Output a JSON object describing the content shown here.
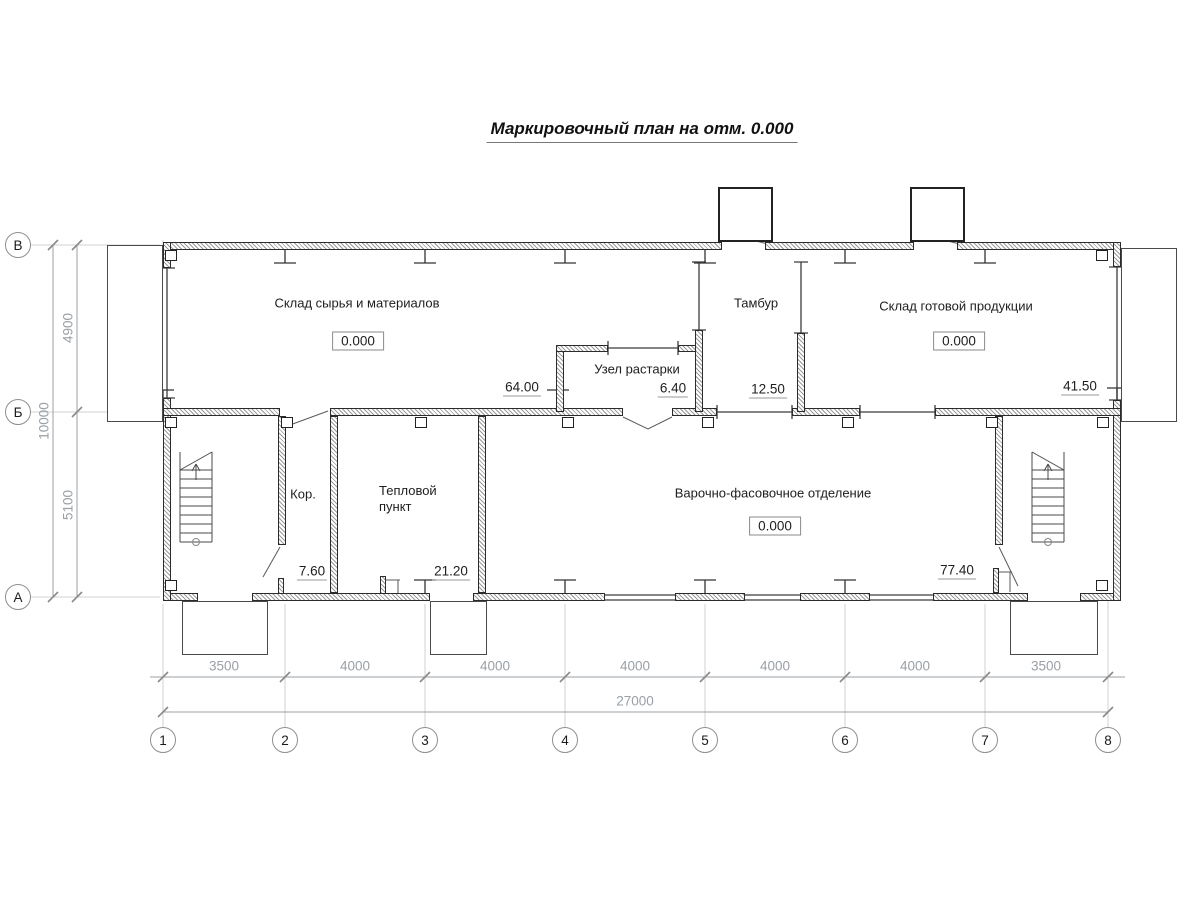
{
  "title": "Маркировочный план на отм. 0.000",
  "rooms": {
    "raw_storage": {
      "label": "Склад сырья и материалов",
      "elevation": "0.000",
      "area": "64.00"
    },
    "unpacking": {
      "label": "Узел растарки",
      "area": "6.40"
    },
    "vestibule": {
      "label": "Тамбур",
      "area": "12.50"
    },
    "finished_storage": {
      "label": "Склад готовой продукции",
      "elevation": "0.000",
      "area": "41.50"
    },
    "corridor": {
      "label": "Кор.",
      "area": "7.60"
    },
    "heat_point": {
      "label": "Тепловой пункт",
      "area": "21.20"
    },
    "cooking": {
      "label": "Варочно-фасовочное отделение",
      "elevation": "0.000",
      "area": "77.40"
    }
  },
  "grid": {
    "columns": [
      "1",
      "2",
      "3",
      "4",
      "5",
      "6",
      "7",
      "8"
    ],
    "rows": [
      "В",
      "Б",
      "А"
    ]
  },
  "dimensions": {
    "bays": [
      "3500",
      "4000",
      "4000",
      "4000",
      "4000",
      "4000",
      "3500"
    ],
    "total_width": "27000",
    "row_spans": [
      "4900",
      "5100"
    ],
    "total_height": "10000"
  },
  "colors": {
    "background": "#ffffff",
    "wall_line": "#2b2b2b",
    "dimension_text": "#9aa0a6"
  }
}
